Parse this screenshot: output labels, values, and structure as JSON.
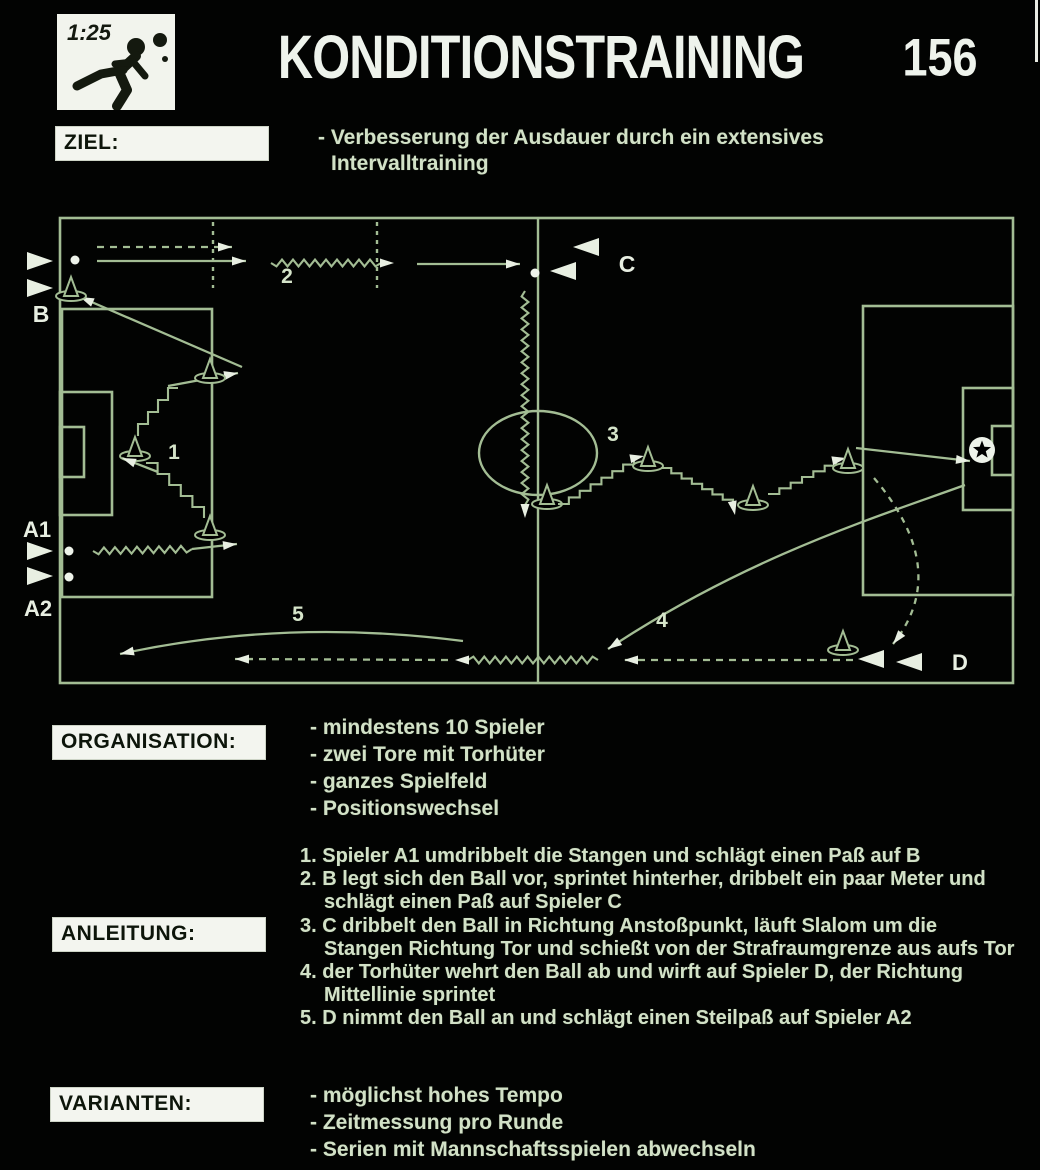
{
  "header": {
    "clock": "1:25",
    "title": "KONDITIONSTRAINING",
    "number": "156"
  },
  "ziel": {
    "label": "ZIEL:",
    "line1": "- Verbesserung der Ausdauer durch ein extensives",
    "line2": "Intervalltraining"
  },
  "organisation": {
    "label": "ORGANISATION:",
    "items": [
      "- mindestens 10 Spieler",
      "- zwei Tore mit Torhüter",
      "- ganzes Spielfeld",
      "- Positionswechsel"
    ]
  },
  "anleitung": {
    "label": "ANLEITUNG:",
    "items": [
      "1. Spieler A1 umdribbelt die Stangen und schlägt einen Paß auf B",
      "2. B legt sich den Ball vor, sprintet hinterher, dribbelt ein paar Meter und schlägt einen Paß auf Spieler C",
      "3. C dribbelt den Ball in Richtung Anstoßpunkt, läuft Slalom um die Stangen Richtung Tor und schießt von der Strafraumgrenze aus aufs Tor",
      "4. der Torhüter wehrt den Ball ab und wirft auf Spieler D, der Richtung Mittellinie sprintet",
      "5. D nimmt den Ball an und schlägt einen Steilpaß auf Spieler A2"
    ]
  },
  "varianten": {
    "label": "VARIANTEN:",
    "items": [
      "- möglichst hohes Tempo",
      "- Zeitmessung pro Runde",
      "- Serien mit Mannschaftsspielen abwechseln"
    ]
  },
  "diagram": {
    "colors": {
      "line": "#a3bd94",
      "bright": "#e8efe2",
      "number": "#d5e4c9",
      "ball": "#eef3ea"
    },
    "labels": [
      {
        "s": "B",
        "x": 41,
        "y": 322,
        "size": 23
      },
      {
        "s": "A1",
        "x": 37,
        "y": 537,
        "size": 22
      },
      {
        "s": "A2",
        "x": 38,
        "y": 616,
        "size": 22
      },
      {
        "s": "C",
        "x": 627,
        "y": 272,
        "size": 23
      },
      {
        "s": "D",
        "x": 960,
        "y": 670,
        "size": 22
      },
      {
        "s": "1",
        "x": 174,
        "y": 459,
        "size": 21,
        "num": true
      },
      {
        "s": "2",
        "x": 287,
        "y": 283,
        "size": 21,
        "num": true
      },
      {
        "s": "3",
        "x": 613,
        "y": 441,
        "size": 21,
        "num": true
      },
      {
        "s": "4",
        "x": 662,
        "y": 627,
        "size": 21,
        "num": true
      },
      {
        "s": "5",
        "x": 298,
        "y": 621,
        "size": 21,
        "num": true
      }
    ],
    "elements": [
      {
        "t": "rect",
        "x": 60,
        "y": 218,
        "w": 953,
        "h": 465
      },
      {
        "t": "line",
        "x1": 538,
        "y1": 218,
        "x2": 538,
        "y2": 683
      },
      {
        "t": "ellipse",
        "x": 538,
        "y": 453,
        "rx": 59,
        "ry": 42
      },
      {
        "t": "rect",
        "x": 62,
        "y": 309,
        "w": 150,
        "h": 288
      },
      {
        "t": "rect",
        "x": 60,
        "y": 392,
        "w": 52,
        "h": 123
      },
      {
        "t": "rect",
        "x": 60,
        "y": 427,
        "w": 24,
        "h": 50
      },
      {
        "t": "rect",
        "x": 863,
        "y": 306,
        "w": 150,
        "h": 289
      },
      {
        "t": "rect",
        "x": 963,
        "y": 388,
        "w": 50,
        "h": 122
      },
      {
        "t": "rect",
        "x": 992,
        "y": 426,
        "w": 21,
        "h": 49
      },
      {
        "t": "line",
        "x1": 213,
        "y1": 222,
        "x2": 213,
        "y2": 288,
        "dash": "4 5"
      },
      {
        "t": "line",
        "x1": 377,
        "y1": 222,
        "x2": 377,
        "y2": 288,
        "dash": "4 5"
      },
      {
        "t": "arrow",
        "x1": 97,
        "y1": 247,
        "x2": 232,
        "y2": 247,
        "dash": "7 6"
      },
      {
        "t": "arrow",
        "x1": 97,
        "y1": 261,
        "x2": 246,
        "y2": 261
      },
      {
        "t": "wavy",
        "x1": 271,
        "y1": 263,
        "x2": 381,
        "y2": 263,
        "arrow": true
      },
      {
        "t": "arrow",
        "x1": 417,
        "y1": 264,
        "x2": 520,
        "y2": 264
      },
      {
        "t": "ball",
        "x": 535,
        "y": 273
      },
      {
        "t": "wavy",
        "x1": 525,
        "y1": 291,
        "x2": 525,
        "y2": 505,
        "arrow": true
      },
      {
        "t": "cone",
        "x": 547,
        "y": 500
      },
      {
        "t": "stair",
        "x1": 558,
        "y1": 504,
        "x2": 634,
        "y2": 458,
        "arrow": [
          1,
          -0.2
        ]
      },
      {
        "t": "cone",
        "x": 648,
        "y": 462
      },
      {
        "t": "stair",
        "x1": 661,
        "y1": 468,
        "x2": 733,
        "y2": 505,
        "arrow": [
          0.2,
          1
        ]
      },
      {
        "t": "cone",
        "x": 753,
        "y": 501
      },
      {
        "t": "stair",
        "x1": 768,
        "y1": 494,
        "x2": 836,
        "y2": 460,
        "arrow": [
          1,
          -0.2
        ]
      },
      {
        "t": "cone",
        "x": 848,
        "y": 464
      },
      {
        "t": "arrow",
        "x1": 856,
        "y1": 448,
        "x2": 970,
        "y2": 461
      },
      {
        "t": "keeper",
        "x": 982,
        "y": 450
      },
      {
        "t": "curve",
        "kind": "C",
        "pts": [
          [
            965,
            485
          ],
          [
            880,
            516
          ],
          [
            748,
            556
          ],
          [
            608,
            649
          ]
        ],
        "arrow": true
      },
      {
        "t": "curve",
        "kind": "Q",
        "pts": [
          [
            874,
            478
          ],
          [
            952,
            570
          ],
          [
            893,
            644
          ]
        ],
        "dash": "6 6",
        "arrow": true
      },
      {
        "t": "cone",
        "x": 843,
        "y": 646
      },
      {
        "t": "player",
        "x": 871,
        "y": 659,
        "dir": "l"
      },
      {
        "t": "player",
        "x": 909,
        "y": 662,
        "dir": "l"
      },
      {
        "t": "arrow",
        "x1": 853,
        "y1": 660,
        "x2": 624,
        "y2": 660,
        "dash": "7 6"
      },
      {
        "t": "wavy",
        "x1": 598,
        "y1": 660,
        "x2": 468,
        "y2": 660,
        "arrow": true
      },
      {
        "t": "arrow",
        "x1": 448,
        "y1": 660,
        "x2": 235,
        "y2": 659,
        "dash": "7 6"
      },
      {
        "t": "curve",
        "kind": "Q",
        "pts": [
          [
            463,
            641
          ],
          [
            285,
            618
          ],
          [
            120,
            654
          ]
        ],
        "arrow": true
      },
      {
        "t": "arrow",
        "x1": 242,
        "y1": 367,
        "x2": 80,
        "y2": 297
      },
      {
        "t": "arrow",
        "x1": 168,
        "y1": 386,
        "x2": 238,
        "y2": 373
      },
      {
        "t": "stair",
        "x1": 178,
        "y1": 388,
        "x2": 138,
        "y2": 436
      },
      {
        "t": "cone",
        "x": 135,
        "y": 452
      },
      {
        "t": "arrow",
        "x1": 158,
        "y1": 472,
        "x2": 122,
        "y2": 458
      },
      {
        "t": "stair",
        "x1": 146,
        "y1": 463,
        "x2": 204,
        "y2": 518
      },
      {
        "t": "cone",
        "x": 210,
        "y": 531
      },
      {
        "t": "cone",
        "x": 210,
        "y": 374
      },
      {
        "t": "cone",
        "x": 71,
        "y": 292
      },
      {
        "t": "player",
        "x": 40,
        "y": 261,
        "dir": "r"
      },
      {
        "t": "player",
        "x": 40,
        "y": 288,
        "dir": "r"
      },
      {
        "t": "ball",
        "x": 75,
        "y": 260
      },
      {
        "t": "player",
        "x": 40,
        "y": 551,
        "dir": "r"
      },
      {
        "t": "player",
        "x": 40,
        "y": 576,
        "dir": "r"
      },
      {
        "t": "ball",
        "x": 69,
        "y": 551
      },
      {
        "t": "ball",
        "x": 69,
        "y": 577
      },
      {
        "t": "wavy",
        "x1": 93,
        "y1": 551,
        "x2": 192,
        "y2": 549
      },
      {
        "t": "arrow",
        "x1": 192,
        "y1": 549,
        "x2": 237,
        "y2": 544
      },
      {
        "t": "player",
        "x": 586,
        "y": 247,
        "dir": "l"
      },
      {
        "t": "player",
        "x": 563,
        "y": 271,
        "dir": "l"
      }
    ]
  }
}
